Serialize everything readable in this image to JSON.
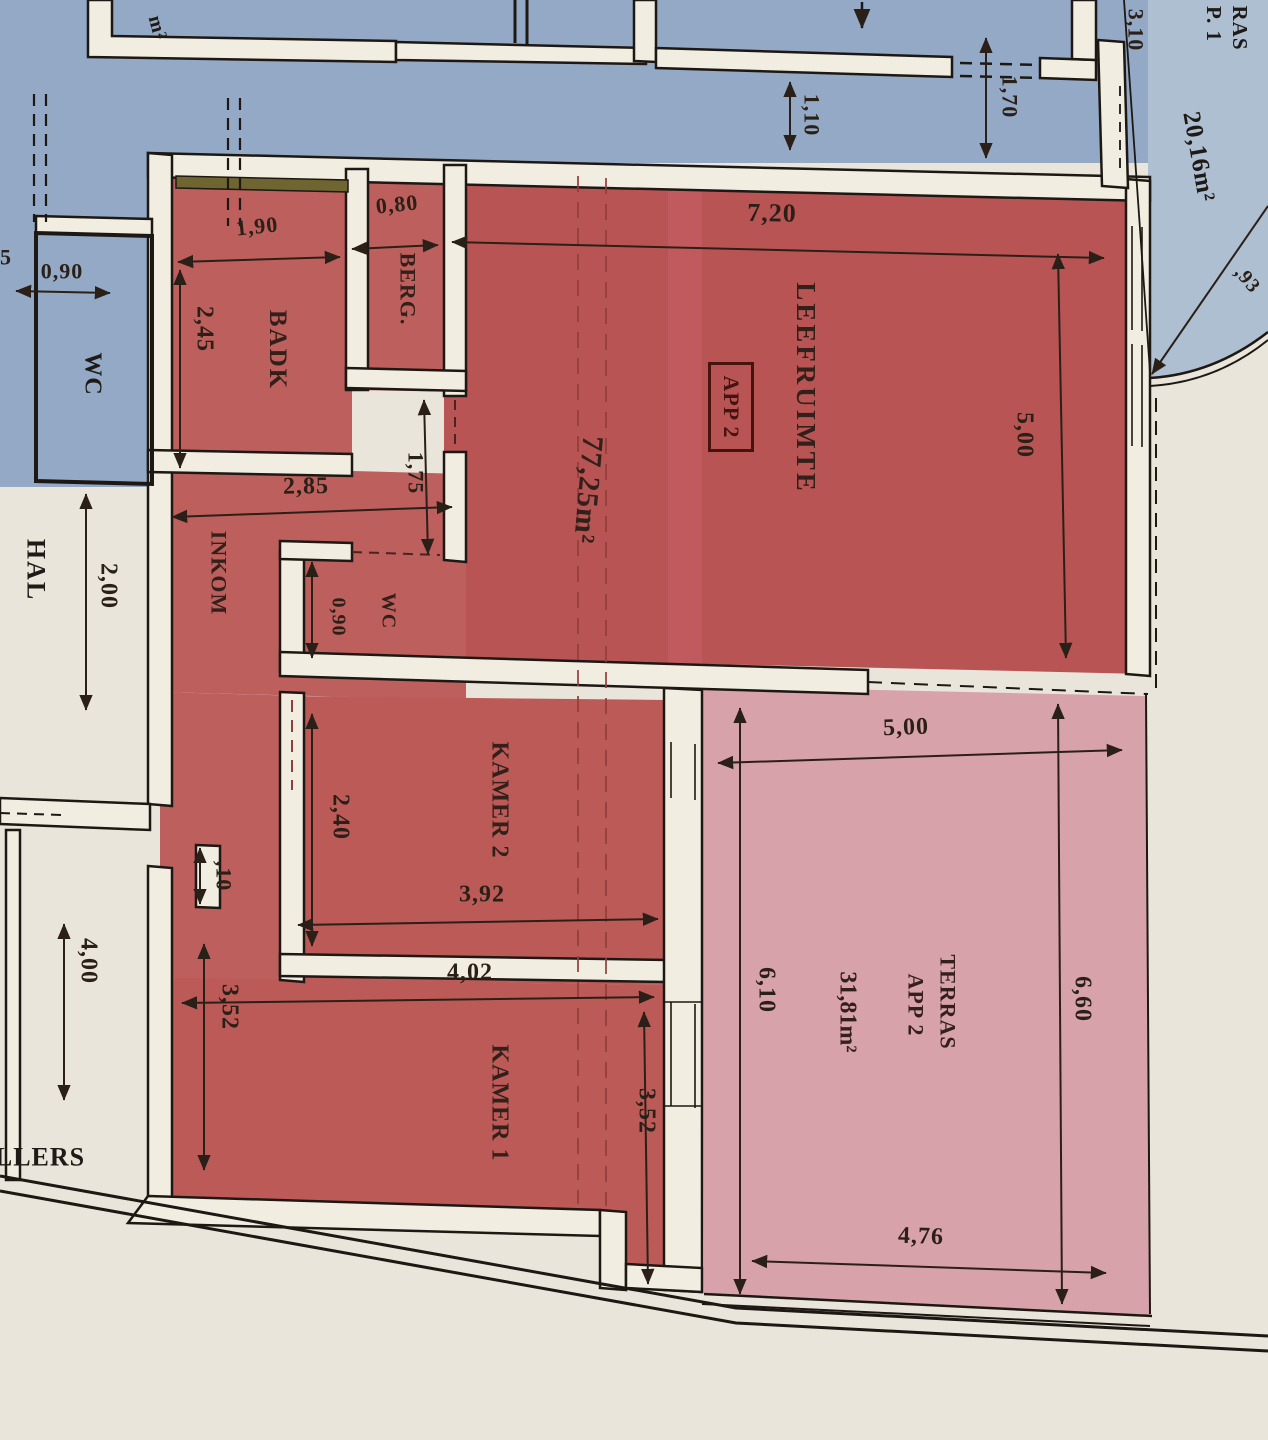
{
  "title": "Scanned architectural floor plan - apartment APP 2 with terrace",
  "rooms": {
    "leefruimte": "LEEFRUIMTE",
    "app_box": "APP 2",
    "badk": "BADK",
    "berg": "BERG.",
    "inkom": "INKOM",
    "wc_red": "WC",
    "kamer2": "KAMER 2",
    "kamer1": "KAMER 1",
    "hal": "HAL",
    "wc_blue": "WC",
    "kelders_partial": "LLERS",
    "terras_line1": "TERRAS",
    "terras_line2": "APP 2",
    "terras_app1_line1": "RAS",
    "terras_app1_line2": "P. 1",
    "corner_m2_partial": "m²"
  },
  "areas": {
    "leefruimte_area": "77,25m²",
    "terras_app2_area": "31,81m²",
    "terras_app1_area": "20,16m²"
  },
  "dims": {
    "top_width": "7,20",
    "leefruimte_height": "5,00",
    "badk_width": "1,90",
    "badk_height": "2,45",
    "berg_width": "0,80",
    "inkom_width": "2,85",
    "passage": "1,75",
    "wc_red_width": "0,90",
    "wc_blue_width": "0,90",
    "hal_width": "2,00",
    "hal_lower_height": "4,00",
    "wall_stub": ",10",
    "kamer1_height_left": "3,52",
    "kamer2_height": "2,40",
    "kamer2_width": "3,92",
    "kamer1_width": "4,02",
    "kamer1_height_right": "3,52",
    "terras_width_top": "5,00",
    "terras_height_left": "6,10",
    "terras_height_right": "6,60",
    "terras_width_bottom": "4,76",
    "blue_gap_1": "1,70",
    "blue_gap_2": "1,10",
    "blue_top_right": "3,10",
    "arc_radius_partial": ",93",
    "left_edge_partial": "5"
  },
  "colors": {
    "paper": "#e9e5da",
    "apartment_fill": "#bb5856",
    "terrace_fill": "#d8a2aa",
    "neighbor_fill": "#94a9c6",
    "wall_core": "#f2ede1",
    "ink": "#1d1813"
  }
}
